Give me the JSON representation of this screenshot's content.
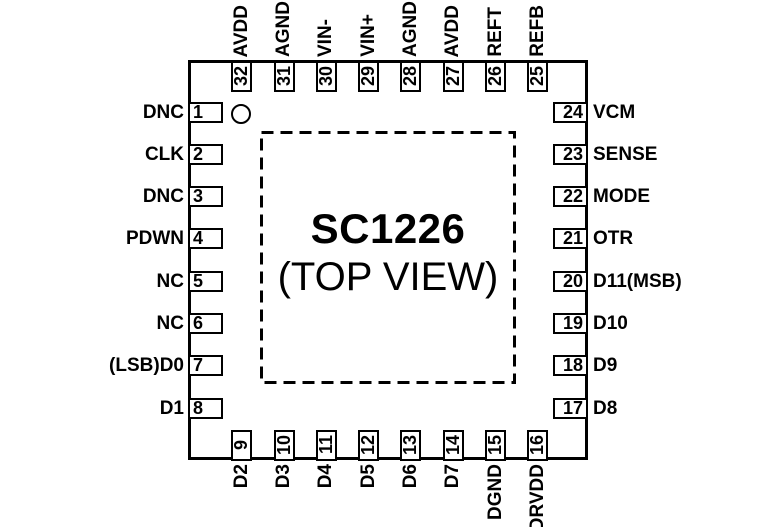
{
  "diagram": {
    "part_number": "SC1226",
    "view_label": "(TOP VIEW)",
    "pin_count": 32
  },
  "pins": {
    "left": [
      {
        "number": "1",
        "label": "DNC"
      },
      {
        "number": "2",
        "label": "CLK"
      },
      {
        "number": "3",
        "label": "DNC"
      },
      {
        "number": "4",
        "label": "PDWN"
      },
      {
        "number": "5",
        "label": "NC"
      },
      {
        "number": "6",
        "label": "NC"
      },
      {
        "number": "7",
        "label": "(LSB)D0"
      },
      {
        "number": "8",
        "label": "D1"
      }
    ],
    "bottom": [
      {
        "number": "9",
        "label": "D2"
      },
      {
        "number": "10",
        "label": "D3"
      },
      {
        "number": "11",
        "label": "D4"
      },
      {
        "number": "12",
        "label": "D5"
      },
      {
        "number": "13",
        "label": "D6"
      },
      {
        "number": "14",
        "label": "D7"
      },
      {
        "number": "15",
        "label": "DGND"
      },
      {
        "number": "16",
        "label": "DRVDD"
      }
    ],
    "right": [
      {
        "number": "24",
        "label": "VCM"
      },
      {
        "number": "23",
        "label": "SENSE"
      },
      {
        "number": "22",
        "label": "MODE"
      },
      {
        "number": "21",
        "label": "OTR"
      },
      {
        "number": "20",
        "label": "D11(MSB)"
      },
      {
        "number": "19",
        "label": "D10"
      },
      {
        "number": "18",
        "label": "D9"
      },
      {
        "number": "17",
        "label": "D8"
      }
    ],
    "top": [
      {
        "number": "32",
        "label": "AVDD"
      },
      {
        "number": "31",
        "label": "AGND"
      },
      {
        "number": "30",
        "label": "VIN-"
      },
      {
        "number": "29",
        "label": "VIN+"
      },
      {
        "number": "28",
        "label": "AGND"
      },
      {
        "number": "27",
        "label": "AVDD"
      },
      {
        "number": "26",
        "label": "REFT"
      },
      {
        "number": "25",
        "label": "REFB"
      }
    ]
  },
  "colors": {
    "line": "#000000",
    "background": "#ffffff"
  }
}
